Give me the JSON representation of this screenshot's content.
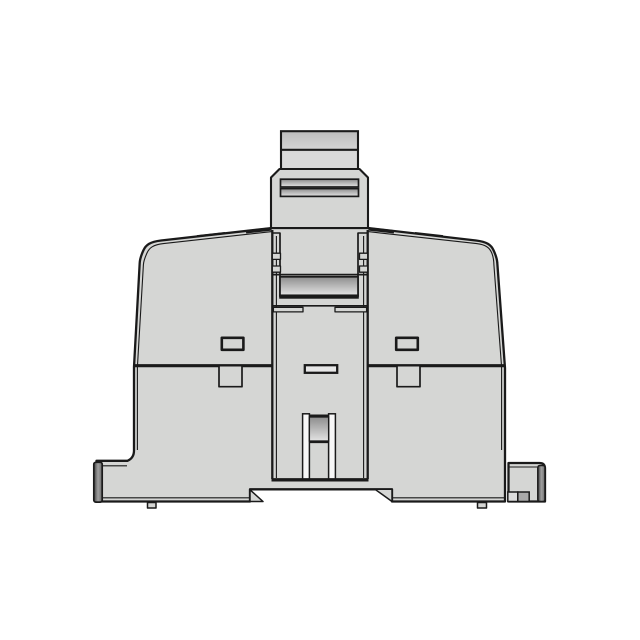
{
  "figure": {
    "title": "DIN-rail module housing, side profile CAD rendering",
    "description": "Monochrome line rendering of a gray plastic DIN-rail mounted module: top locking clamp with ridged plunger, trapezoidal housing with ogee shoulders, two vent slots, central wiring channel with release slot, bottom rail notch and mounting feet",
    "parts": [
      "plunger-tab",
      "clamp-block",
      "clamp-ridges",
      "housing-body",
      "body-divide-line",
      "vent-slot-left",
      "vent-slot-right",
      "latch-tab-left",
      "latch-tab-right",
      "center-channel",
      "channel-marker-slot",
      "release-slot-bars",
      "release-roller",
      "rail-notch",
      "foot-left-end-cap",
      "foot-right-block",
      "foot-pads"
    ]
  },
  "palette": {
    "background": "#ffffff",
    "outline": "#1a1a1a",
    "body_gray": "#d5d6d4",
    "highlight_white": "#f7f7f7",
    "slot_gray": "#e7e7e7",
    "band_dark": "#8d8d8d",
    "band_light": "#e3e3e3",
    "tab_dark": "#bcbcbc",
    "tab_light": "#d9d9d9",
    "bar_dark": "#3f3f3f",
    "bar_mid": "#a0a0a0",
    "bar_end": "#6b6b6b",
    "square_light": "#dcdcdc",
    "square_mid": "#a9a9a9"
  }
}
